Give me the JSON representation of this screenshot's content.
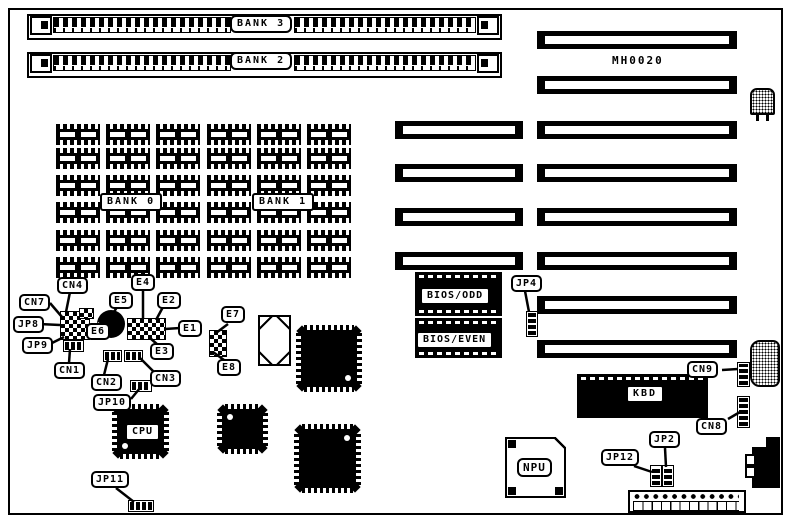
{
  "board_id": "MH0020",
  "memory": {
    "simm_banks": [
      {
        "label": "BANK 3"
      },
      {
        "label": "BANK 2"
      }
    ],
    "dram_banks": [
      {
        "label": "BANK 0"
      },
      {
        "label": "BANK 1"
      }
    ]
  },
  "chips": {
    "bios_odd": "BIOS/ODD",
    "bios_even": "BIOS/EVEN",
    "kbd": "KBD",
    "cpu": "CPU",
    "npu": "NPU"
  },
  "callouts": {
    "cn4": "CN4",
    "cn7": "CN7",
    "jp8": "JP8",
    "jp9": "JP9",
    "e5": "E5",
    "e4": "E4",
    "e2": "E2",
    "e6": "E6",
    "e1": "E1",
    "e3": "E3",
    "e7": "E7",
    "e8": "E8",
    "cn1": "CN1",
    "cn2": "CN2",
    "cn3": "CN3",
    "jp10": "JP10",
    "jp4": "JP4",
    "cn9": "CN9",
    "cn8": "CN8",
    "jp2": "JP2",
    "jp12": "JP12",
    "jp11": "JP11"
  },
  "colors": {
    "ink": "#000000",
    "paper": "#ffffff"
  }
}
